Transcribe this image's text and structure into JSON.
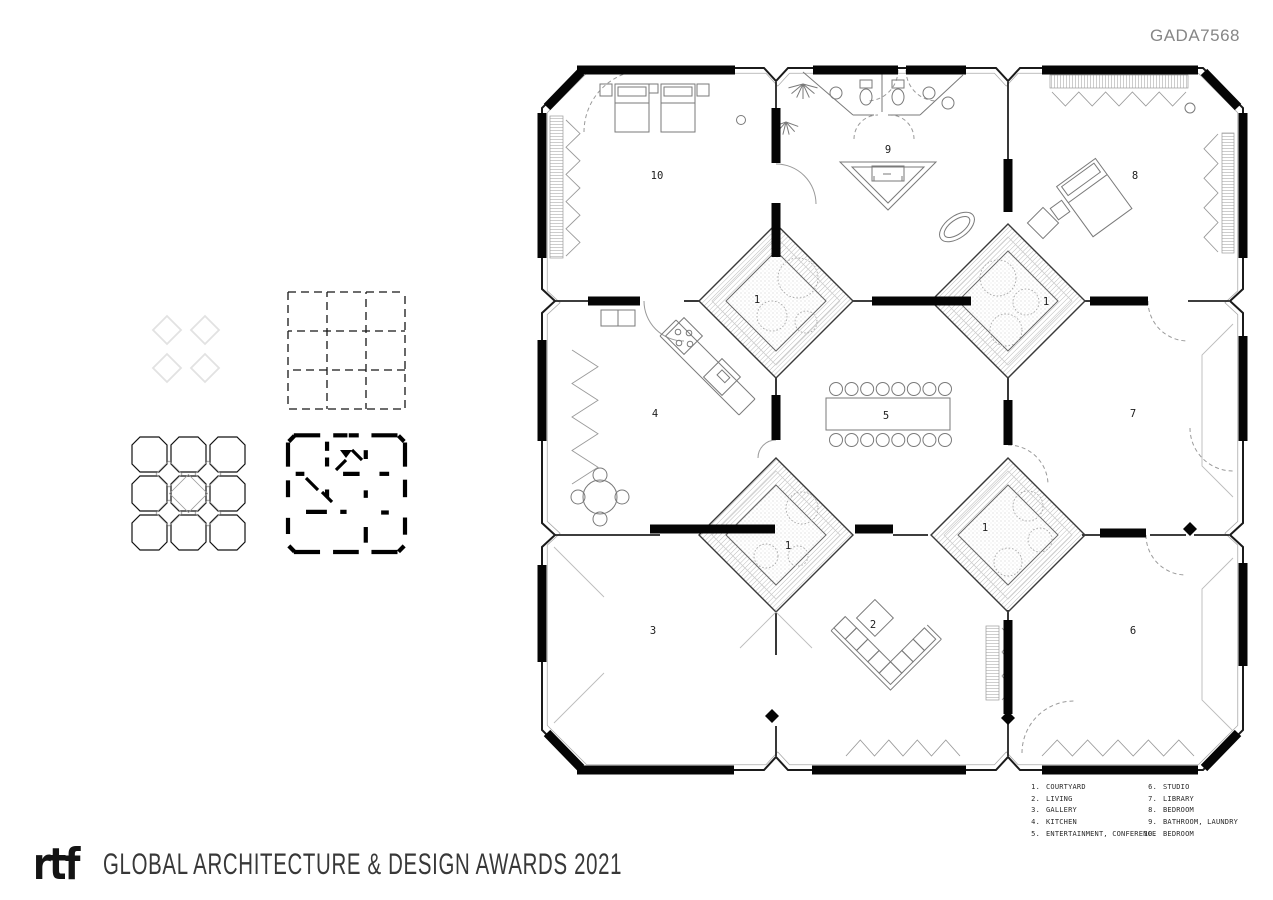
{
  "code": "GADA7568",
  "footer": {
    "logo": "rtf",
    "title": "GLOBAL ARCHITECTURE & DESIGN AWARDS 2021"
  },
  "legend": {
    "columns": [
      [
        {
          "n": "1.",
          "t": "COURTYARD"
        },
        {
          "n": "2.",
          "t": "LIVING"
        },
        {
          "n": "3.",
          "t": "GALLERY"
        },
        {
          "n": "4.",
          "t": "KITCHEN"
        },
        {
          "n": "5.",
          "t": "ENTERTAINMENT, CONFERENCE"
        }
      ],
      [
        {
          "n": "6.",
          "t": "STUDIO"
        },
        {
          "n": "7.",
          "t": "LIBRARY"
        },
        {
          "n": "8.",
          "t": "BEDROOM"
        },
        {
          "n": "9.",
          "t": "BATHROOM, LAUNDRY"
        },
        {
          "n": "10.",
          "t": "BEDROOM"
        }
      ]
    ]
  },
  "plan": {
    "room_labels": [
      {
        "t": "10",
        "x": 657,
        "y": 179
      },
      {
        "t": "9",
        "x": 888,
        "y": 153
      },
      {
        "t": "8",
        "x": 1135,
        "y": 179
      },
      {
        "t": "4",
        "x": 655,
        "y": 417
      },
      {
        "t": "5",
        "x": 886,
        "y": 419
      },
      {
        "t": "7",
        "x": 1133,
        "y": 417
      },
      {
        "t": "3",
        "x": 653,
        "y": 634
      },
      {
        "t": "2",
        "x": 873,
        "y": 628
      },
      {
        "t": "6",
        "x": 1133,
        "y": 634
      },
      {
        "t": "1",
        "x": 757,
        "y": 303
      },
      {
        "t": "1",
        "x": 1046,
        "y": 305
      },
      {
        "t": "1",
        "x": 788,
        "y": 549
      },
      {
        "t": "1",
        "x": 985,
        "y": 531
      }
    ]
  },
  "colors": {
    "ink": "#1a1a1a",
    "wall": "#222222",
    "furniture": "#7a7a7a",
    "pale": "#e2e2e2",
    "code_text": "#868686",
    "title_text": "#383838"
  }
}
